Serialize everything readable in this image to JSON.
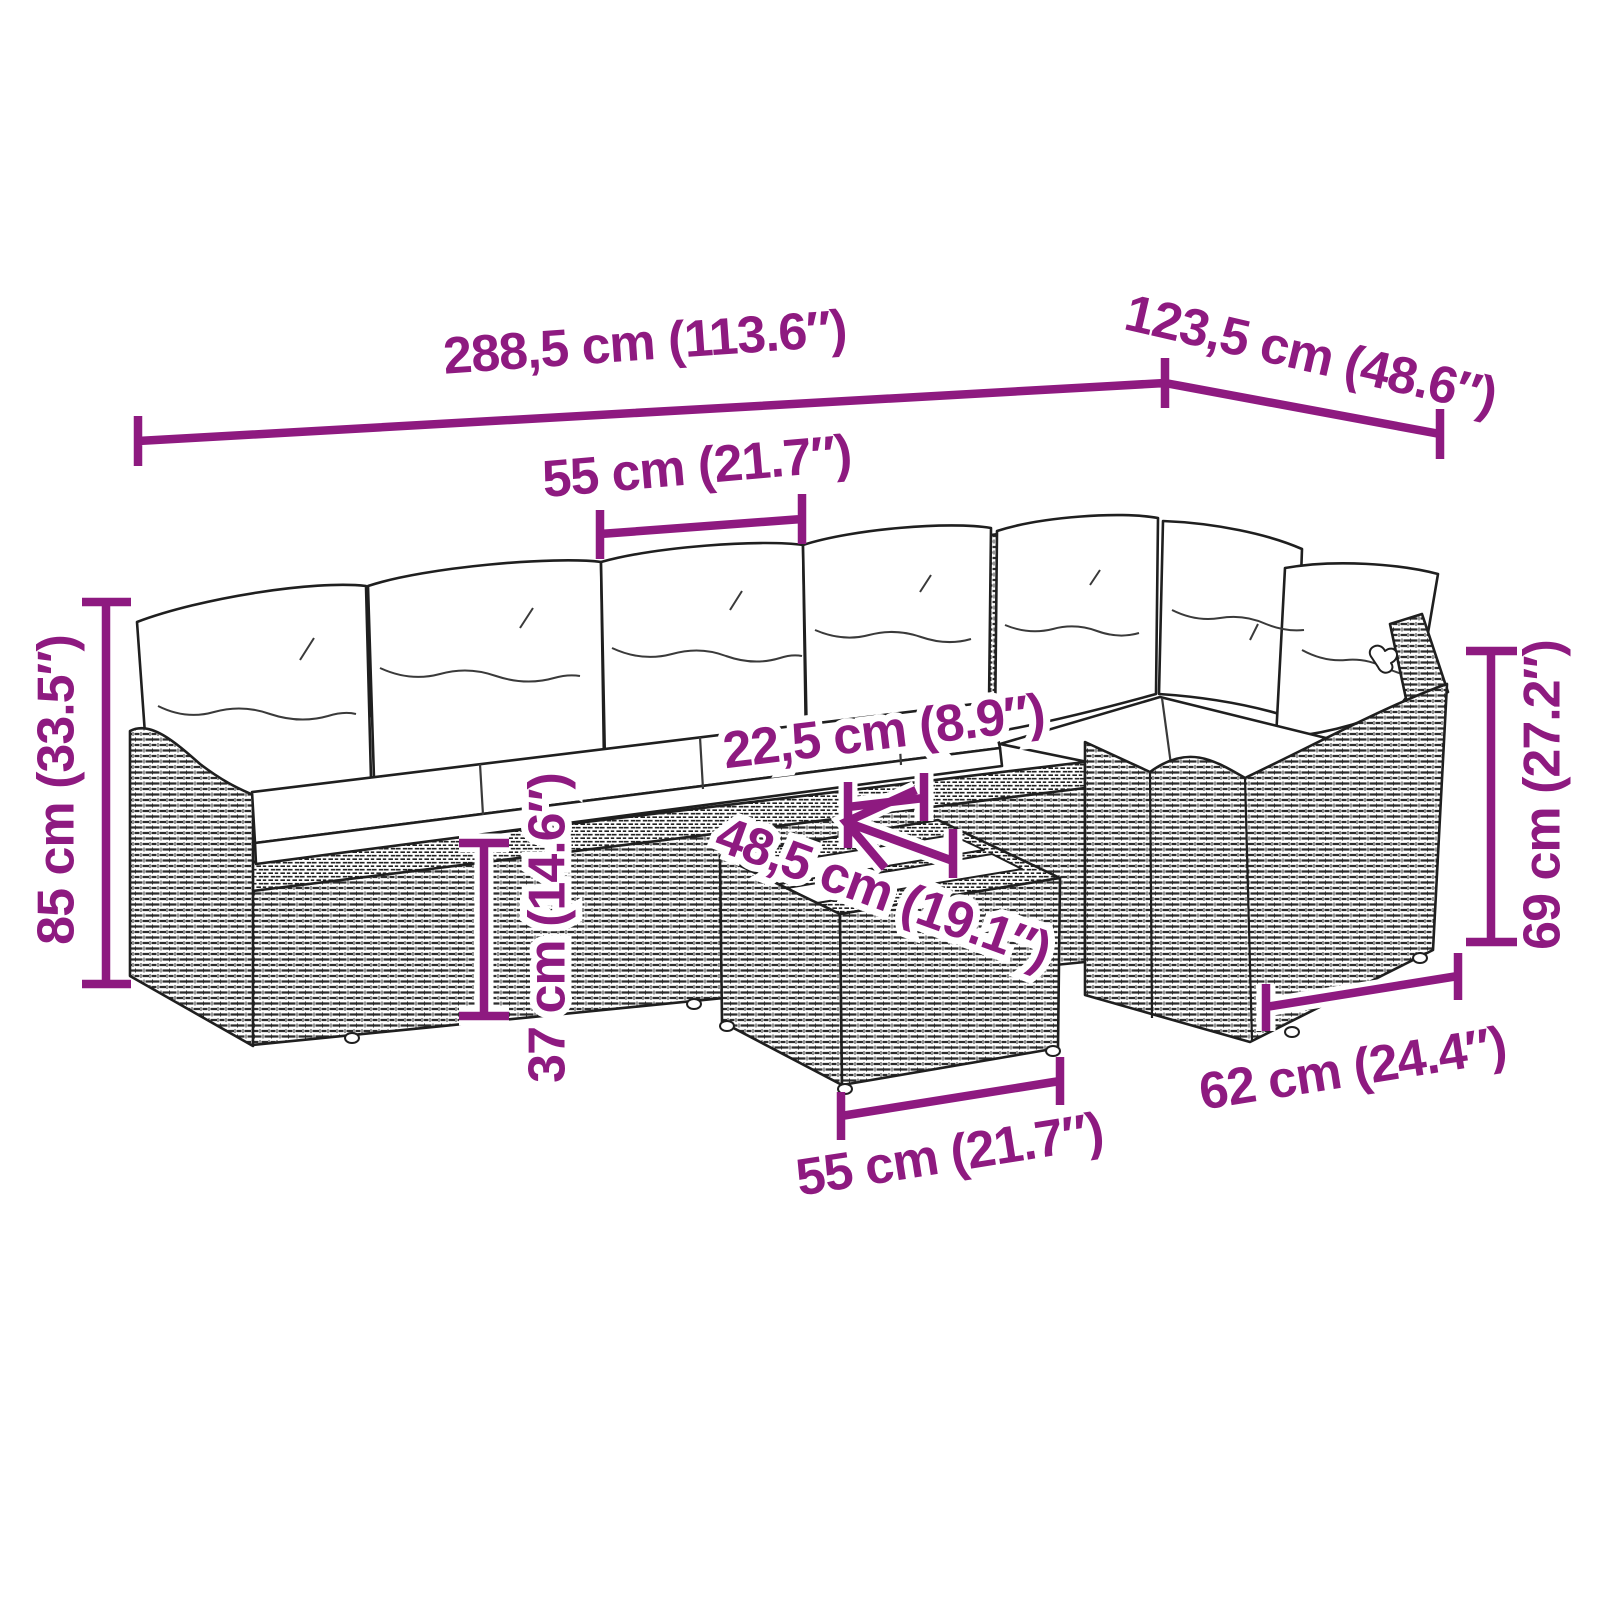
{
  "alt": "Line drawing of an L-shaped poly rattan garden sofa set with white seat and back cushions and a slatted-top coffee table, annotated with purple dimension lines",
  "colors": {
    "dimension_annotation": "#8E1A80",
    "line_art": "#1f1f1f",
    "cushion_fill": "#ffffff",
    "background": "#ffffff"
  },
  "dimensions": {
    "overall_width": {
      "cm": "288,5",
      "inches": "113.6",
      "label": "288,5 cm (113.6″)"
    },
    "overall_depth": {
      "cm": "123,5",
      "inches": "48.6",
      "label": "123,5 cm (48.6″)"
    },
    "seat_width": {
      "cm": "55",
      "inches": "21.7",
      "label": "55 cm (21.7″)"
    },
    "overall_height": {
      "cm": "85",
      "inches": "33.5",
      "label": "85 cm (33.5″)"
    },
    "armrest_top_width": {
      "cm": "22,5",
      "inches": "8.9",
      "label": "22,5 cm (8.9″)"
    },
    "table_depth": {
      "cm": "48,5",
      "inches": "19.1",
      "label": "48,5 cm (19.1″)"
    },
    "seat_height": {
      "cm": "37",
      "inches": "14.6",
      "label": "37 cm (14.6″)"
    },
    "armrest_height": {
      "cm": "69",
      "inches": "27.2",
      "label": "69 cm (27.2″)"
    },
    "end_section_depth": {
      "cm": "62",
      "inches": "24.4",
      "label": "62 cm (24.4″)"
    },
    "table_width": {
      "cm": "55",
      "inches": "21.7",
      "label": "55 cm (21.7″)"
    }
  }
}
